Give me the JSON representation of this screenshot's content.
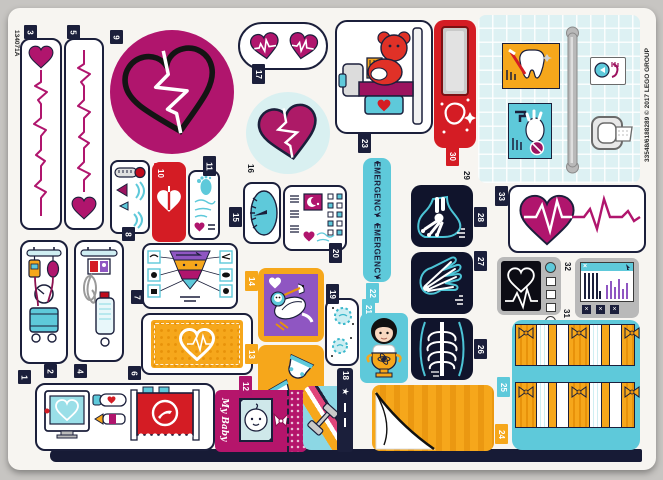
{
  "edge_codes": {
    "left": "134071A",
    "right": "33548/6188289 © 2017 LEGO GROUP"
  },
  "labels": {
    "emergency": "EMERGENCY",
    "baby_book_script": "My Baby",
    "star": "★",
    "close_x": "×"
  },
  "palette": {
    "navy": "#1b1f3b",
    "magenta": "#b0156d",
    "red": "#d41c24",
    "cyan": "#5ec9da",
    "mint": "#d9f0f1",
    "orange": "#f6a71b",
    "purple": "#8f56c2",
    "xray_navy": "#10142c",
    "frame_gray": "#b9b9b9",
    "sheet": "#f7f5f1"
  },
  "stickers": [
    {
      "num": "1",
      "subject": "medical equipment cart with monitor, bottles and red machine"
    },
    {
      "num": "2",
      "subject": "blood pressure trolley with gauge"
    },
    {
      "num": "3",
      "subject": "vertical heart ECG strip, heart at top"
    },
    {
      "num": "4",
      "subject": "IV drip stand with bottle"
    },
    {
      "num": "5",
      "subject": "vertical heart ECG strip, heart at bottom"
    },
    {
      "num": "6",
      "subject": "orange blanket with heart stitch"
    },
    {
      "num": "7",
      "subject": "nutrition pyramid chart"
    },
    {
      "num": "8",
      "subject": "thermometer control panel"
    },
    {
      "num": "9",
      "subject": "magenta circle with heart and heartbeat"
    },
    {
      "num": "10",
      "subject": "red tag with heart-lungs"
    },
    {
      "num": "11",
      "subject": "baby footprint record card"
    },
    {
      "num": "12",
      "subject": "baby book cover with photo"
    },
    {
      "num": "13",
      "subject": "babies in diapers on orange"
    },
    {
      "num": "14",
      "subject": "stork carrying baby on purple"
    },
    {
      "num": "15",
      "subject": "weighing scale dial"
    },
    {
      "num": "16",
      "subject": "heart on mint circle"
    },
    {
      "num": "17",
      "subject": "two small heartbeat hearts"
    },
    {
      "num": "18",
      "subject": "rainbow stripe with dumbbell and star"
    },
    {
      "num": "19",
      "subject": "germs card"
    },
    {
      "num": "20",
      "subject": "patient chart with checkboxes"
    },
    {
      "num": "21",
      "subject": "girl holding trophy"
    },
    {
      "num": "22",
      "subject": "emergency banner"
    },
    {
      "num": "23",
      "subject": "teddy bear on x-ray table"
    },
    {
      "num": "24",
      "subject": "orange striped page with curled corner"
    },
    {
      "num": "25",
      "subject": "presents banner on cyan"
    },
    {
      "num": "26",
      "subject": "ribcage x-ray"
    },
    {
      "num": "27",
      "subject": "hand x-ray"
    },
    {
      "num": "28",
      "subject": "foot x-ray"
    },
    {
      "num": "29",
      "subject": "bathroom tile panel with posters and grab bar"
    },
    {
      "num": "30",
      "subject": "red dispenser with cup"
    },
    {
      "num": "31",
      "subject": "heart rate monitor"
    },
    {
      "num": "32",
      "subject": "computer screen with bar chart"
    },
    {
      "num": "33",
      "subject": "heart with heartbeat banner"
    }
  ]
}
